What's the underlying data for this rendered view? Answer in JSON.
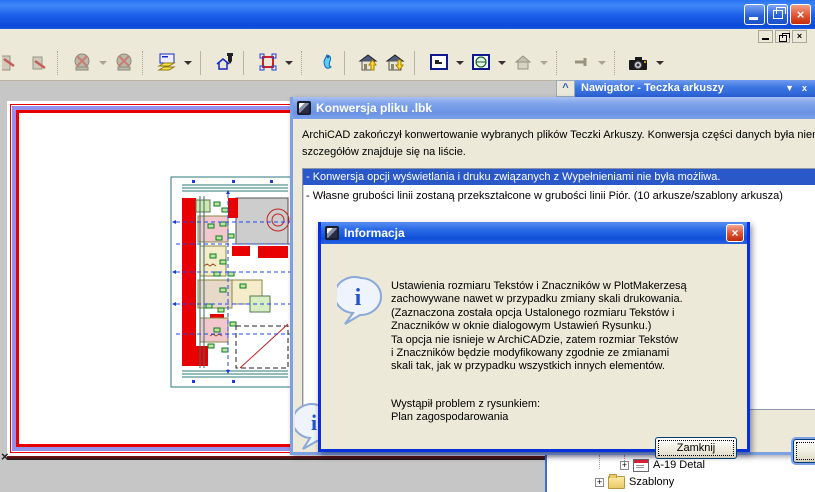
{
  "window": {
    "controls": {
      "minimize": "_",
      "restore": "restore",
      "close": "×"
    },
    "mdi_controls": {
      "minimize": "_",
      "restore": "restore",
      "close": "×"
    }
  },
  "toolbar": {
    "icons": [
      "doc-partial-left",
      "doc-partial-right",
      "stamp-disabled",
      "dropdown-disabled",
      "stamp2-disabled",
      "layers",
      "dropdown",
      "house-plumb",
      "marquee",
      "dropdown",
      "seahorse",
      "house-arrow-up",
      "house-arrow-down",
      "layout-sheet",
      "dropdown",
      "globe",
      "dropdown",
      "model-disabled",
      "dropdown-disabled",
      "section-disabled",
      "dropdown-disabled",
      "camera",
      "dropdown"
    ]
  },
  "navigator": {
    "chevron": "^",
    "title": "Nawigator - Teczka arkuszy",
    "collapse_glyph": "▼",
    "close_glyph": "x",
    "tree": [
      {
        "expander": "+",
        "icon": "sheet-icon",
        "label": "A-19 Detal"
      },
      {
        "expander": "+",
        "icon": "folder-icon",
        "label": "Szablony"
      }
    ]
  },
  "canvas": {
    "origin_marker": "×",
    "drawing": "site-plan-drawing"
  },
  "dialog_konwersja": {
    "title": "Konwersja pliku .lbk",
    "message_line1": "ArchiCAD zakończył konwertowanie wybranych plików Teczki Arkuszy. Konwersja części danych była niemożliwa. Lista",
    "message_line2": "szczegółów znajduje się na liście.",
    "list": [
      {
        "text": "- Konwersja opcji wyświetlania i druku związanych z Wypełnieniami nie była możliwa.",
        "selected": true
      },
      {
        "text": "- Własne grubości linii zostaną przekształcone w grubości linii Piór. (10 arkusze/szablony arkusza)",
        "selected": false
      }
    ],
    "info_icon": "i"
  },
  "dialog_informacja": {
    "title": "Informacja",
    "close_glyph": "×",
    "info_icon": "i",
    "body_lines": [
      "Ustawienia rozmiaru Tekstów i Znaczników w PlotMakerzesą",
      "zachowywane nawet w przypadku zmiany skali drukowania.",
      "(Zaznaczona została opcja Ustalonego rozmiaru Tekstów i",
      "Znaczników w oknie dialogowym Ustawień Rysunku.)",
      "Ta opcja nie isnieje w ArchiCADzie, zatem rozmiar Tekstów",
      "i Znaczników będzie modyfikowany zgodnie ze zmianami",
      "skali tak, jak w przypadku wszystkich innych elementów."
    ],
    "problem_line1": "Wystąpił problem z rysunkiem:",
    "problem_line2": "Plan zagospodarowania",
    "close_button": "Zamknij"
  },
  "colors": {
    "titlebar_blue": "#1b5ee8",
    "dialog_border_active": "#0831d9",
    "dialog_border_inactive": "#7e9fe2",
    "dialog_body": "#ece9d8",
    "selected_row": "#2b58c8",
    "close_red": "#e05535",
    "canvas_gray": "#c6c6c6",
    "page_border_red": "#e80000",
    "page_border_blue": "#9292ec"
  }
}
